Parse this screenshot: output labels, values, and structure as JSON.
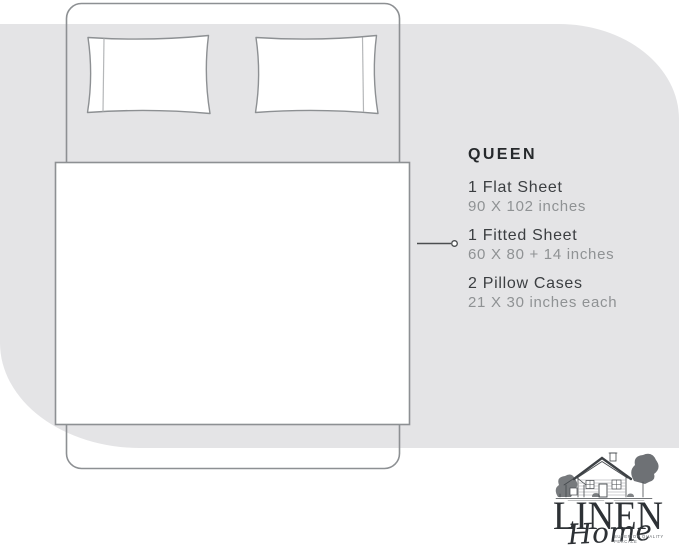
{
  "specs": {
    "size_label": "QUEEN",
    "items": [
      {
        "name": "1 Flat Sheet",
        "dimensions": "90 X 102 inches"
      },
      {
        "name": "1 Fitted Sheet",
        "dimensions": "60 X 80 + 14 inches"
      },
      {
        "name": "2 Pillow Cases",
        "dimensions": "21 X 30 inches each"
      }
    ]
  },
  "diagram": {
    "subject": "queen bed top view line drawing",
    "pillow_count": 2,
    "pointer_target": "1 Fitted Sheet"
  },
  "logo": {
    "brand_name": "LINEN",
    "brand_script": "Home",
    "tagline_line1": "SUPERIOR QUALITY",
    "tagline_line2": "PERCALE"
  },
  "colors": {
    "background_shape": "#e4e4e6",
    "line_art": "#8d9093",
    "pointer": "#4b4e50",
    "title_text": "#26292c",
    "item_text": "#3b3e41",
    "muted_text": "#8f9294",
    "logo_ink": "#2d3135"
  }
}
